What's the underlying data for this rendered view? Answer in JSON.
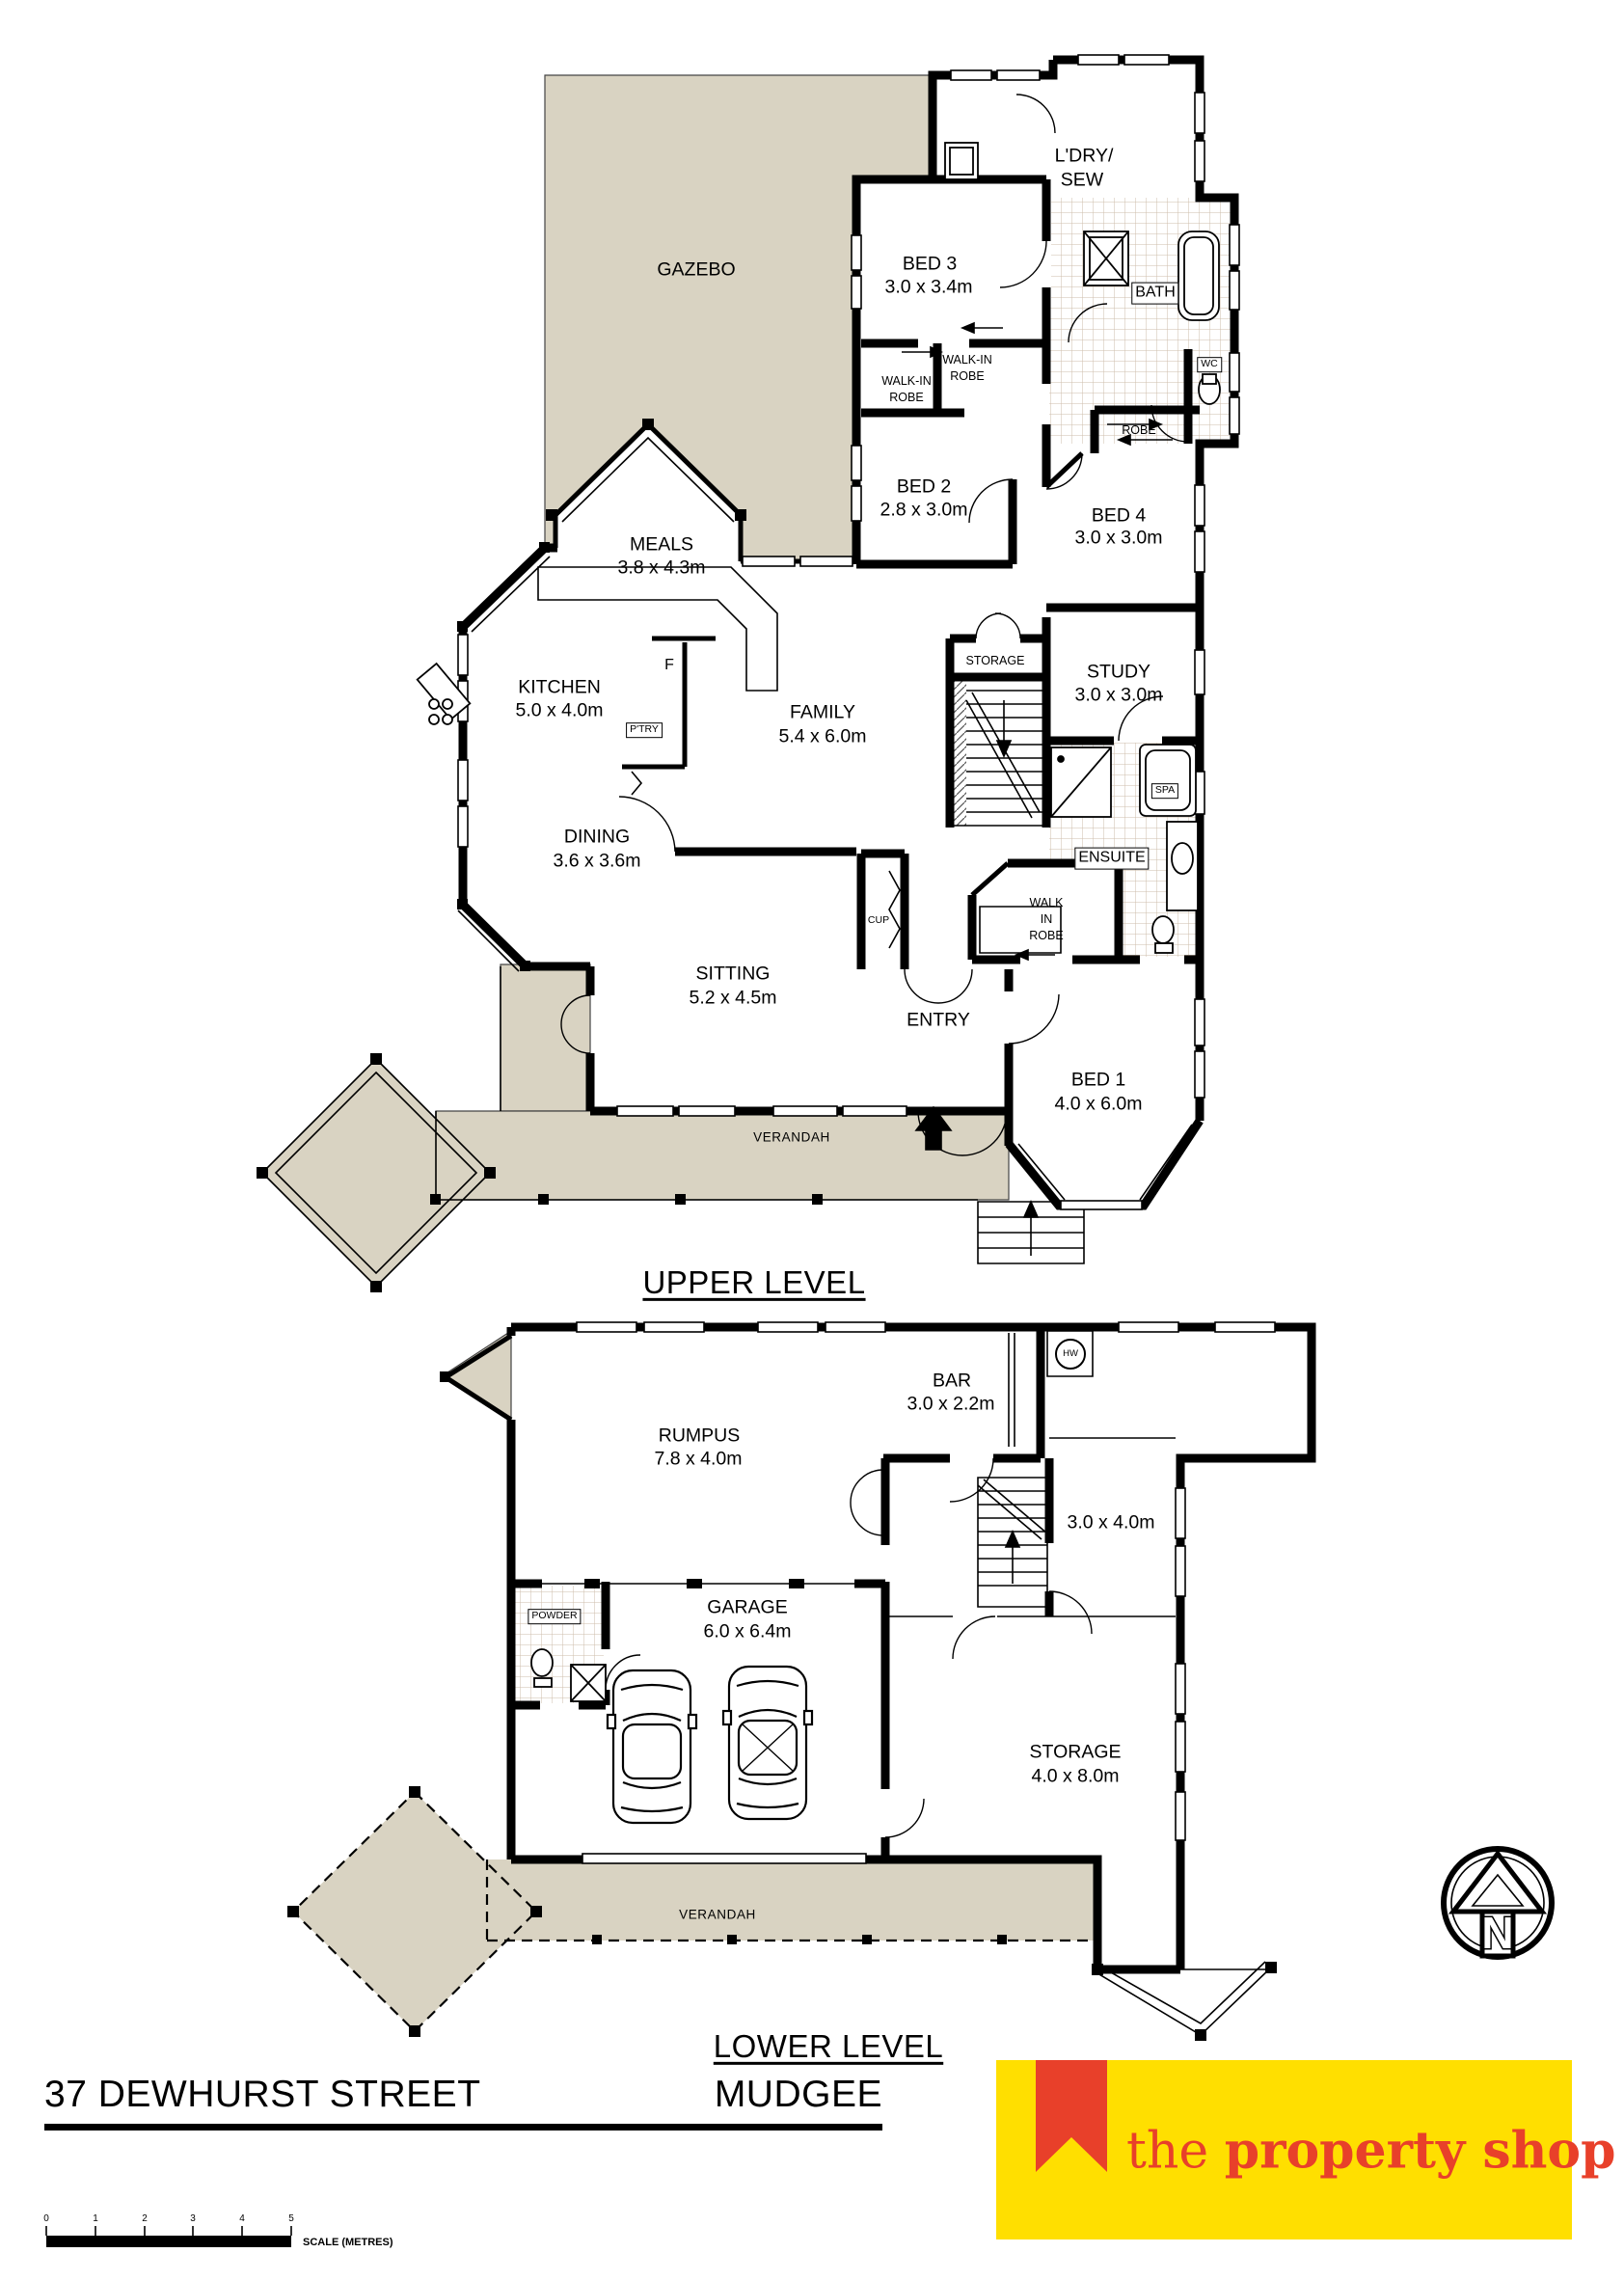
{
  "upper": {
    "title": "UPPER LEVEL",
    "gazebo": "GAZEBO",
    "verandah": "VERANDAH",
    "ldry1": "L'DRY/",
    "ldry2": "SEW",
    "bed3": {
      "name": "BED 3",
      "dims": "3.0 x 3.4m"
    },
    "bed2": {
      "name": "BED 2",
      "dims": "2.8 x 3.0m"
    },
    "bed4": {
      "name": "BED 4",
      "dims": "3.0 x 3.0m"
    },
    "bed1": {
      "name": "BED 1",
      "dims": "4.0 x 6.0m"
    },
    "meals": {
      "name": "MEALS",
      "dims": "3.8 x 4.3m"
    },
    "kitchen": {
      "name": "KITCHEN",
      "dims": "5.0 x 4.0m"
    },
    "family": {
      "name": "FAMILY",
      "dims": "5.4 x 6.0m"
    },
    "study": {
      "name": "STUDY",
      "dims": "3.0 x 3.0m"
    },
    "dining": {
      "name": "DINING",
      "dims": "3.6 x 3.6m"
    },
    "sitting": {
      "name": "SITTING",
      "dims": "5.2 x 4.5m"
    },
    "wir_bed3": [
      "WALK-IN",
      "ROBE"
    ],
    "wir_bed2": [
      "WALK-IN",
      "ROBE"
    ],
    "wir_bed1": [
      "WALK",
      "IN",
      "ROBE"
    ],
    "bath": "BATH",
    "wc": "WC",
    "robe": "ROBE",
    "spa": "SPA",
    "ensuite": "ENSUITE",
    "storage": "STORAGE",
    "fridge": "F",
    "pantry": "P'TRY",
    "cup": "CUP",
    "entry": "ENTRY"
  },
  "lower": {
    "title": "LOWER LEVEL",
    "rumpus": {
      "name": "RUMPUS",
      "dims": "7.8 x 4.0m"
    },
    "bar": {
      "name": "BAR",
      "dims": "3.0 x 2.2m"
    },
    "garage": {
      "name": "GARAGE",
      "dims": "6.0 x 6.4m"
    },
    "storage": {
      "name": "STORAGE",
      "dims": "4.0 x 8.0m"
    },
    "room": "3.0 x 4.0m",
    "hw": "HW",
    "powder": "POWDER",
    "verandah": "VERANDAH"
  },
  "footer": {
    "address": "37 DEWHURST STREET",
    "town": "MUDGEE",
    "scale_ticks": [
      "0",
      "1",
      "2",
      "3",
      "4",
      "5"
    ],
    "scale_caption": "SCALE (METRES)"
  },
  "brand": {
    "the": "the ",
    "rest": "property shop"
  },
  "north": "N",
  "colors": {
    "deck": "#d9d3c2",
    "logo_yellow": "#ffdf00",
    "logo_red": "#e8402a",
    "wall": "#000000"
  }
}
